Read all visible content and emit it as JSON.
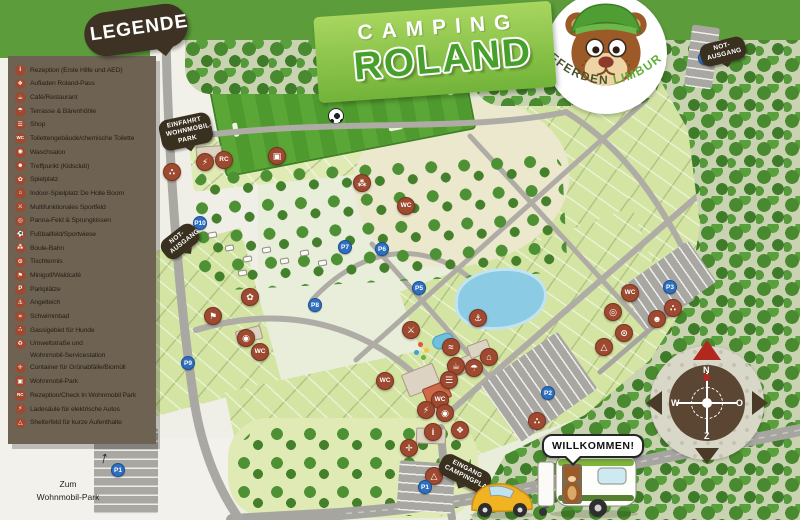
{
  "colors": {
    "header_green": "#5c9c3b",
    "legend_panel_brown": "#6e6353",
    "legend_icon_red": "#9d4a31",
    "marker_red": "#9d4a31",
    "parking_blue": "#2f6fc0",
    "bubble_dark": "#3a3020",
    "forest_green": "#49892f",
    "plot_green": "#d3e4a3",
    "pond_blue": "#8ccbe4",
    "logo_green": "#47a02b"
  },
  "legend": {
    "title": "LEGENDE",
    "items": [
      {
        "icon": "reception-info",
        "glyph": "i",
        "label": "Rezeption (Erste Hilfe und AED)"
      },
      {
        "icon": "roland-pass",
        "glyph": "❖",
        "label": "Aufladen Roland-Pass"
      },
      {
        "icon": "cafe",
        "glyph": "☕",
        "label": "Café/Restaurant"
      },
      {
        "icon": "terrace",
        "glyph": "☂",
        "label": "Terrasse & Bärenhöhle"
      },
      {
        "icon": "shop",
        "glyph": "☰",
        "label": "Shop"
      },
      {
        "icon": "toilets",
        "glyph": "WC",
        "label": "Toilettengebäude/chemische Toilette"
      },
      {
        "icon": "laundry",
        "glyph": "◉",
        "label": "Waschsalon"
      },
      {
        "icon": "kidsclub",
        "glyph": "☻",
        "label": "Treffpunkt (Kidsclub)"
      },
      {
        "icon": "playground",
        "glyph": "✿",
        "label": "Spielplatz"
      },
      {
        "icon": "indoor-playground",
        "glyph": "⌂",
        "label": "Indoor-Spielplatz De Holle Boom"
      },
      {
        "icon": "multisport",
        "glyph": "⚔",
        "label": "Multifunktionales Sportfeld"
      },
      {
        "icon": "panna-field",
        "glyph": "◎",
        "label": "Panna-Feld & Sprungkissen"
      },
      {
        "icon": "soccer-field",
        "glyph": "⚽",
        "label": "Fußballfeld/Sportwiese"
      },
      {
        "icon": "boule",
        "glyph": "⁂",
        "label": "Boule-Bahn"
      },
      {
        "icon": "table-tennis",
        "glyph": "⊙",
        "label": "Tischtennis"
      },
      {
        "icon": "minigolf",
        "glyph": "⚑",
        "label": "Minigolf/Waldcafé"
      },
      {
        "icon": "parking",
        "glyph": "P",
        "label": "Parkplätze"
      },
      {
        "icon": "fishing-pond",
        "glyph": "⚓",
        "label": "Angelteich"
      },
      {
        "icon": "swimming-pool",
        "glyph": "≈",
        "label": "Schwimmbad"
      },
      {
        "icon": "dog-walking",
        "glyph": "∴",
        "label": "Gassigebiet für Hunde"
      },
      {
        "icon": "service-station",
        "glyph": "♻",
        "label": "Umweltstraße und",
        "label2": "Wohnmobil-Servicestation"
      },
      {
        "icon": "green-waste",
        "glyph": "✛",
        "label": "Container für Grünabfälle/Biomüll"
      },
      {
        "icon": "motorhome-park",
        "glyph": "▣",
        "label": "Wohnmobil-Park"
      },
      {
        "icon": "rc-checkin",
        "glyph": "RC",
        "label": "Rezeption/Check In Wohnmobil Park"
      },
      {
        "icon": "ev-charging",
        "glyph": "⚡",
        "label": "Ladesäule für elektrische Autos"
      },
      {
        "icon": "shelter-field",
        "glyph": "△",
        "label": "Shelterfeld für kurze Aufenthalte"
      }
    ]
  },
  "logo": {
    "camping": "CAMPING",
    "roland": "ROLAND",
    "afferden": "AFFERDEN",
    "limburg": "LIMBURG"
  },
  "bubbles": {
    "einfahrt": [
      "EINFAHRT",
      "WOHNMOBIL-PARK"
    ],
    "notausgang_links": [
      "NOT-",
      "AUSGANG"
    ],
    "notausgang_rechts": [
      "NOT-",
      "AUSGANG"
    ],
    "eingang": [
      "EINGANG",
      "CAMPINGPLATZ"
    ],
    "willkommen": "WILLKOMMEN!"
  },
  "footer": {
    "zum": [
      "Zum",
      "Wohnmobil-Park"
    ],
    "arrow": "↑"
  },
  "compass": {
    "n": "N",
    "o": "O",
    "z": "Z",
    "w": "W"
  },
  "map": {
    "markers": [
      {
        "name": "gassigebiet-hunde",
        "glyph": "∴",
        "x": 172,
        "y": 172
      },
      {
        "name": "ladesaeule-wohnmobil",
        "glyph": "⚡",
        "x": 205,
        "y": 162
      },
      {
        "name": "rc-checkin",
        "glyph": "RC",
        "x": 224,
        "y": 160,
        "txt": true
      },
      {
        "name": "wohnmobil-park",
        "glyph": "▣",
        "x": 277,
        "y": 156
      },
      {
        "name": "boule-bahn",
        "glyph": "⁂",
        "x": 362,
        "y": 183
      },
      {
        "name": "toiletten-nord",
        "glyph": "WC",
        "x": 406,
        "y": 206,
        "txt": true
      },
      {
        "name": "spielplatz-west",
        "glyph": "✿",
        "x": 250,
        "y": 297
      },
      {
        "name": "minigolf",
        "glyph": "⚑",
        "x": 213,
        "y": 316
      },
      {
        "name": "waschsalon-west",
        "glyph": "◉",
        "x": 246,
        "y": 338
      },
      {
        "name": "toiletten-west",
        "glyph": "WC",
        "x": 260,
        "y": 352,
        "txt": true
      },
      {
        "name": "multifunktionales-sportfeld",
        "glyph": "⚔",
        "x": 411,
        "y": 330
      },
      {
        "name": "angelteich",
        "glyph": "⚓",
        "x": 478,
        "y": 318
      },
      {
        "name": "schwimmbad",
        "glyph": "≈",
        "x": 451,
        "y": 347
      },
      {
        "name": "indoor-spielplatz",
        "glyph": "⌂",
        "x": 489,
        "y": 357
      },
      {
        "name": "cafe-restaurant",
        "glyph": "☕",
        "x": 456,
        "y": 366
      },
      {
        "name": "terrasse-baerenhoehle",
        "glyph": "☂",
        "x": 474,
        "y": 368
      },
      {
        "name": "shop",
        "glyph": "☰",
        "x": 449,
        "y": 380
      },
      {
        "name": "toiletten-mitte",
        "glyph": "WC",
        "x": 440,
        "y": 400,
        "txt": true
      },
      {
        "name": "ladesaeule-mitte",
        "glyph": "⚡",
        "x": 426,
        "y": 410
      },
      {
        "name": "waschsalon-mitte",
        "glyph": "◉",
        "x": 445,
        "y": 413
      },
      {
        "name": "rezeption",
        "glyph": "i",
        "x": 433,
        "y": 432
      },
      {
        "name": "aufladen-roland-pass",
        "glyph": "❖",
        "x": 460,
        "y": 430
      },
      {
        "name": "container-gruenabfaelle",
        "glyph": "✛",
        "x": 409,
        "y": 448
      },
      {
        "name": "shelterfeld-sued",
        "glyph": "△",
        "x": 434,
        "y": 476
      },
      {
        "name": "toiletten-ost",
        "glyph": "WC",
        "x": 385,
        "y": 381,
        "txt": true
      },
      {
        "name": "toiletten-nordost",
        "glyph": "WC",
        "x": 630,
        "y": 293,
        "txt": true
      },
      {
        "name": "panna-feld",
        "glyph": "◎",
        "x": 613,
        "y": 312
      },
      {
        "name": "treffpunkt-kidsclub",
        "glyph": "☻",
        "x": 657,
        "y": 319
      },
      {
        "name": "tischtennis",
        "glyph": "⊙",
        "x": 624,
        "y": 333
      },
      {
        "name": "shelterfeld-ost",
        "glyph": "△",
        "x": 604,
        "y": 347
      },
      {
        "name": "gassigebiet-ost",
        "glyph": "∴",
        "x": 673,
        "y": 308
      },
      {
        "name": "gassigebiet-sued",
        "glyph": "∴",
        "x": 537,
        "y": 421
      }
    ],
    "parking": [
      {
        "label": "P1",
        "x": 425,
        "y": 487
      },
      {
        "label": "P1",
        "x": 118,
        "y": 470
      },
      {
        "label": "P2",
        "x": 548,
        "y": 393
      },
      {
        "label": "P3",
        "x": 670,
        "y": 287
      },
      {
        "label": "P4",
        "x": 705,
        "y": 58
      },
      {
        "label": "P5",
        "x": 419,
        "y": 288
      },
      {
        "label": "P6",
        "x": 382,
        "y": 249
      },
      {
        "label": "P7",
        "x": 345,
        "y": 247
      },
      {
        "label": "P8",
        "x": 315,
        "y": 305
      },
      {
        "label": "P9",
        "x": 188,
        "y": 363
      },
      {
        "label": "P10",
        "x": 200,
        "y": 223
      }
    ]
  }
}
